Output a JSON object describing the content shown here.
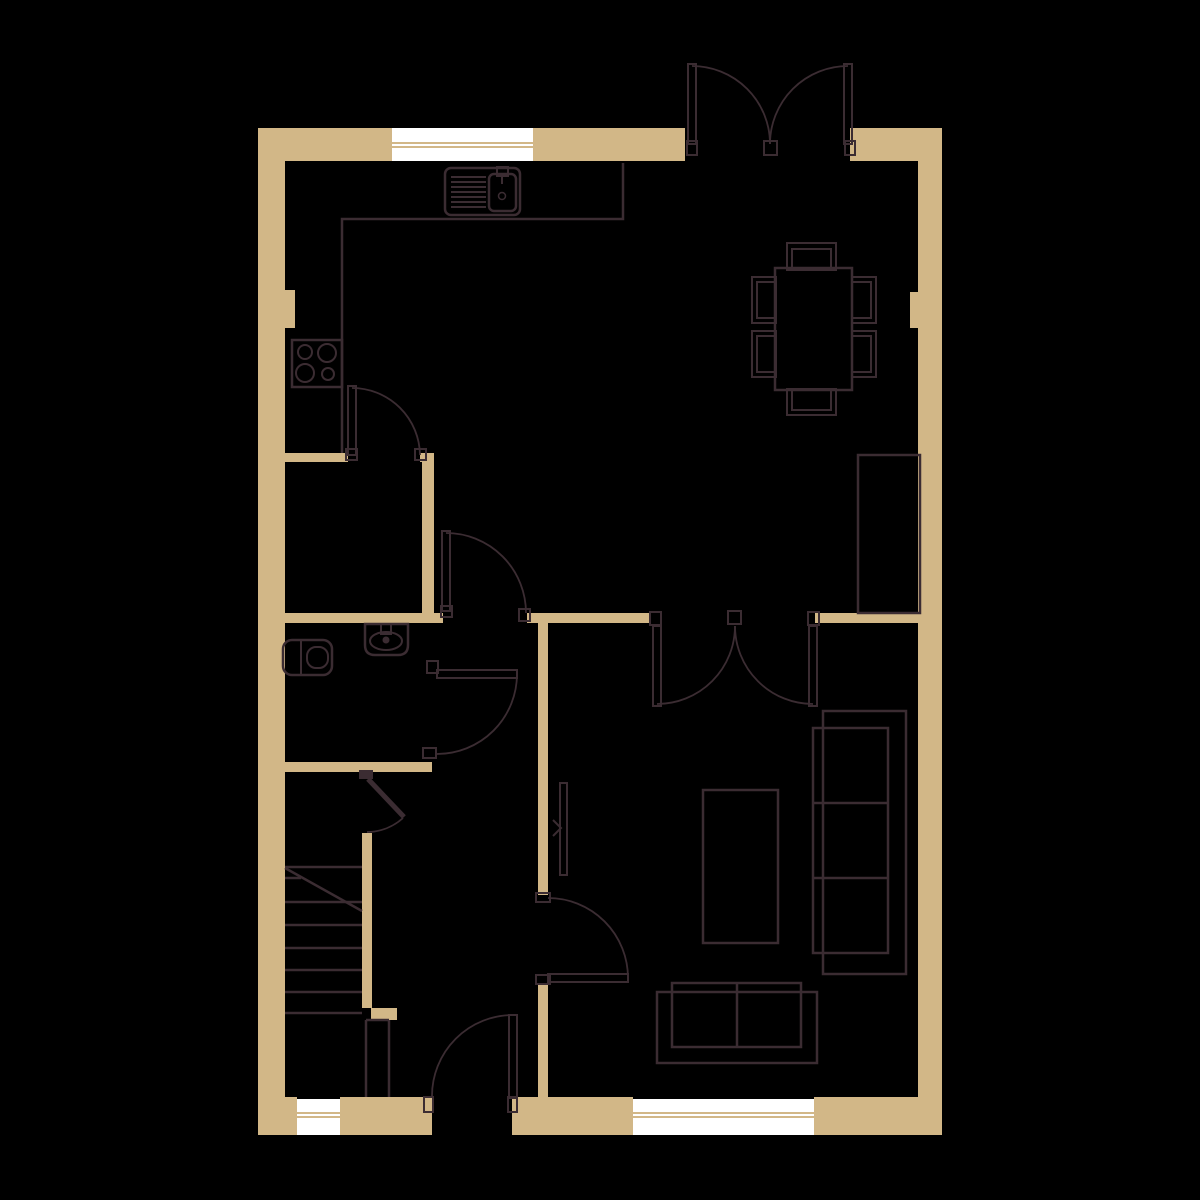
{
  "title": "ground-floor-plan",
  "canvas": {
    "width": 1200,
    "height": 1200,
    "background": "#000000"
  },
  "colors": {
    "wall": "#d2b787",
    "line": "#3b2c32",
    "window": "#ffffff",
    "background": "#000000",
    "none": "none"
  },
  "shapes": [
    {
      "name": "wall-top-left",
      "type": "rect",
      "x": 258,
      "y": 128,
      "w": 427,
      "h": 33,
      "fill": "wall"
    },
    {
      "name": "wall-top-right",
      "type": "rect",
      "x": 850,
      "y": 128,
      "w": 92,
      "h": 33,
      "fill": "wall"
    },
    {
      "name": "wall-left",
      "type": "rect",
      "x": 258,
      "y": 161,
      "w": 27,
      "h": 936,
      "fill": "wall"
    },
    {
      "name": "wall-right",
      "type": "rect",
      "x": 918,
      "y": 161,
      "w": 24,
      "h": 936,
      "fill": "wall"
    },
    {
      "name": "pillar-left",
      "type": "rect",
      "x": 258,
      "y": 290,
      "w": 37,
      "h": 38,
      "fill": "wall"
    },
    {
      "name": "pillar-right",
      "type": "rect",
      "x": 910,
      "y": 292,
      "w": 32,
      "h": 36,
      "fill": "wall"
    },
    {
      "name": "wall-kitchen",
      "type": "rect",
      "x": 258,
      "y": 453,
      "w": 90,
      "h": 9,
      "fill": "wall"
    },
    {
      "name": "wall-kitchen-stub",
      "type": "rect",
      "x": 420,
      "y": 453,
      "w": 14,
      "h": 9,
      "fill": "wall"
    },
    {
      "name": "wall-kitchen-vert",
      "type": "rect",
      "x": 422,
      "y": 462,
      "w": 12,
      "h": 153,
      "fill": "wall"
    },
    {
      "name": "wall-mid-1",
      "type": "rect",
      "x": 258,
      "y": 613,
      "w": 185,
      "h": 10,
      "fill": "wall"
    },
    {
      "name": "wall-mid-2",
      "type": "rect",
      "x": 527,
      "y": 613,
      "w": 123,
      "h": 10,
      "fill": "wall"
    },
    {
      "name": "wall-mid-3",
      "type": "rect",
      "x": 815,
      "y": 613,
      "w": 105,
      "h": 10,
      "fill": "wall"
    },
    {
      "name": "wall-hall-upper",
      "type": "rect",
      "x": 538,
      "y": 623,
      "w": 10,
      "h": 272,
      "fill": "wall"
    },
    {
      "name": "wall-hall-lower",
      "type": "rect",
      "x": 538,
      "y": 983,
      "w": 10,
      "h": 114,
      "fill": "wall"
    },
    {
      "name": "wall-wc-bottom",
      "type": "rect",
      "x": 258,
      "y": 762,
      "w": 174,
      "h": 10,
      "fill": "wall"
    },
    {
      "name": "wall-stairs",
      "type": "rect",
      "x": 362,
      "y": 833,
      "w": 10,
      "h": 175,
      "fill": "wall"
    },
    {
      "name": "wall-newel",
      "type": "rect",
      "x": 371,
      "y": 1008,
      "w": 26,
      "h": 12,
      "fill": "wall"
    },
    {
      "name": "wall-bottom-1",
      "type": "rect",
      "x": 258,
      "y": 1097,
      "w": 39,
      "h": 38,
      "fill": "wall"
    },
    {
      "name": "wall-bottom-2",
      "type": "rect",
      "x": 340,
      "y": 1097,
      "w": 92,
      "h": 38,
      "fill": "wall"
    },
    {
      "name": "wall-bottom-3",
      "type": "rect",
      "x": 512,
      "y": 1097,
      "w": 121,
      "h": 38,
      "fill": "wall"
    },
    {
      "name": "wall-bottom-4",
      "type": "rect",
      "x": 814,
      "y": 1097,
      "w": 128,
      "h": 38,
      "fill": "wall"
    },
    {
      "name": "window-top",
      "type": "rect",
      "x": 392,
      "y": 128,
      "w": 141,
      "h": 33,
      "fill": "window"
    },
    {
      "name": "window-top-bar-1",
      "type": "rect",
      "x": 392,
      "y": 142,
      "w": 141,
      "h": 2,
      "fill": "wall"
    },
    {
      "name": "window-top-bar-2",
      "type": "rect",
      "x": 392,
      "y": 146,
      "w": 141,
      "h": 2,
      "fill": "wall"
    },
    {
      "name": "window-bottom-left",
      "type": "rect",
      "x": 297,
      "y": 1099,
      "w": 43,
      "h": 36,
      "fill": "window"
    },
    {
      "name": "window-bl-bar-1",
      "type": "rect",
      "x": 297,
      "y": 1112,
      "w": 43,
      "h": 2,
      "fill": "wall"
    },
    {
      "name": "window-bl-bar-2",
      "type": "rect",
      "x": 297,
      "y": 1116,
      "w": 43,
      "h": 2,
      "fill": "wall"
    },
    {
      "name": "window-bottom-right",
      "type": "rect",
      "x": 633,
      "y": 1099,
      "w": 181,
      "h": 36,
      "fill": "window"
    },
    {
      "name": "window-br-bar-1",
      "type": "rect",
      "x": 633,
      "y": 1112,
      "w": 181,
      "h": 2,
      "fill": "wall"
    },
    {
      "name": "window-br-bar-2",
      "type": "rect",
      "x": 633,
      "y": 1116,
      "w": 181,
      "h": 2,
      "fill": "wall"
    },
    {
      "name": "kitchen-counter-edge",
      "type": "path",
      "d": "M623 163 V219 H342 V453",
      "stroke": "line",
      "sw": 2.5
    },
    {
      "name": "sink-outline",
      "type": "rect",
      "x": 445,
      "y": 168,
      "w": 75,
      "h": 47,
      "rx": 6,
      "stroke": "line",
      "sw": 2.5
    },
    {
      "name": "sink-drainer-lines",
      "type": "path",
      "d": "M451 177 H486 M451 182 H486 M451 187 H486 M451 192 H486 M451 197 H486 M451 202 H486 M451 207 H486",
      "stroke": "line",
      "sw": 2
    },
    {
      "name": "sink-basin",
      "type": "rect",
      "x": 489,
      "y": 174,
      "w": 27,
      "h": 37,
      "rx": 5,
      "stroke": "line",
      "sw": 2.5
    },
    {
      "name": "sink-tap",
      "type": "rect",
      "x": 497,
      "y": 167,
      "w": 11,
      "h": 9,
      "stroke": "line",
      "sw": 2
    },
    {
      "name": "sink-tap-spout",
      "type": "line",
      "x1": 502,
      "y1": 176,
      "x2": 502,
      "y2": 184,
      "stroke": "line",
      "sw": 2
    },
    {
      "name": "sink-drain",
      "type": "circle",
      "cx": 502,
      "cy": 196,
      "r": 3.5,
      "stroke": "line",
      "sw": 1.5
    },
    {
      "name": "hob-outline",
      "type": "rect",
      "x": 292,
      "y": 340,
      "w": 50,
      "h": 47,
      "stroke": "line",
      "sw": 2.5
    },
    {
      "name": "hob-burner-1",
      "type": "circle",
      "cx": 305,
      "cy": 352,
      "r": 7,
      "stroke": "line",
      "sw": 2
    },
    {
      "name": "hob-burner-2",
      "type": "circle",
      "cx": 327,
      "cy": 353,
      "r": 9,
      "stroke": "line",
      "sw": 2
    },
    {
      "name": "hob-burner-3",
      "type": "circle",
      "cx": 305,
      "cy": 373,
      "r": 9,
      "stroke": "line",
      "sw": 2
    },
    {
      "name": "hob-burner-4",
      "type": "circle",
      "cx": 328,
      "cy": 374,
      "r": 6,
      "stroke": "line",
      "sw": 2
    },
    {
      "name": "dining-table",
      "type": "rect",
      "x": 775,
      "y": 268,
      "w": 77,
      "h": 122,
      "stroke": "line",
      "sw": 2.5
    },
    {
      "name": "chair-top-outer",
      "type": "rect",
      "x": 787,
      "y": 243,
      "w": 49,
      "h": 27,
      "stroke": "line",
      "sw": 2
    },
    {
      "name": "chair-top-inner",
      "type": "rect",
      "x": 792,
      "y": 249,
      "w": 39,
      "h": 21,
      "stroke": "line",
      "sw": 2
    },
    {
      "name": "chair-bottom-outer",
      "type": "rect",
      "x": 787,
      "y": 389,
      "w": 49,
      "h": 26,
      "stroke": "line",
      "sw": 2
    },
    {
      "name": "chair-bottom-inner",
      "type": "rect",
      "x": 792,
      "y": 389,
      "w": 39,
      "h": 21,
      "stroke": "line",
      "sw": 2
    },
    {
      "name": "chair-left-top-outer",
      "type": "rect",
      "x": 752,
      "y": 277,
      "w": 24,
      "h": 46,
      "stroke": "line",
      "sw": 2
    },
    {
      "name": "chair-left-top-inner",
      "type": "rect",
      "x": 757,
      "y": 282,
      "w": 19,
      "h": 36,
      "stroke": "line",
      "sw": 2
    },
    {
      "name": "chair-left-bot-outer",
      "type": "rect",
      "x": 752,
      "y": 331,
      "w": 24,
      "h": 46,
      "stroke": "line",
      "sw": 2
    },
    {
      "name": "chair-left-bot-inner",
      "type": "rect",
      "x": 757,
      "y": 336,
      "w": 19,
      "h": 36,
      "stroke": "line",
      "sw": 2
    },
    {
      "name": "chair-right-top-outer",
      "type": "rect",
      "x": 852,
      "y": 277,
      "w": 24,
      "h": 46,
      "stroke": "line",
      "sw": 2
    },
    {
      "name": "chair-right-top-inner",
      "type": "rect",
      "x": 852,
      "y": 282,
      "w": 19,
      "h": 36,
      "stroke": "line",
      "sw": 2
    },
    {
      "name": "chair-right-bot-outer",
      "type": "rect",
      "x": 852,
      "y": 331,
      "w": 24,
      "h": 46,
      "stroke": "line",
      "sw": 2
    },
    {
      "name": "chair-right-bot-inner",
      "type": "rect",
      "x": 852,
      "y": 336,
      "w": 19,
      "h": 36,
      "stroke": "line",
      "sw": 2
    },
    {
      "name": "tv-unit",
      "type": "rect",
      "x": 858,
      "y": 455,
      "w": 62,
      "h": 158,
      "stroke": "line",
      "sw": 2.5
    },
    {
      "name": "sofa-3seat-back",
      "type": "rect",
      "x": 823,
      "y": 711,
      "w": 83,
      "h": 263,
      "stroke": "line",
      "sw": 2.5
    },
    {
      "name": "sofa-3seat-cushions",
      "type": "rect",
      "x": 813,
      "y": 728,
      "w": 75,
      "h": 225,
      "stroke": "line",
      "sw": 2.5
    },
    {
      "name": "sofa-3seat-dividers",
      "type": "path",
      "d": "M813 803 H888 M813 878 H888",
      "stroke": "line",
      "sw": 2.5
    },
    {
      "name": "coffee-table",
      "type": "rect",
      "x": 703,
      "y": 790,
      "w": 75,
      "h": 153,
      "stroke": "line",
      "sw": 2.5
    },
    {
      "name": "sofa-2seat-back",
      "type": "rect",
      "x": 657,
      "y": 992,
      "w": 160,
      "h": 71,
      "stroke": "line",
      "sw": 2.5
    },
    {
      "name": "sofa-2seat-cushions",
      "type": "rect",
      "x": 672,
      "y": 983,
      "w": 129,
      "h": 64,
      "stroke": "line",
      "sw": 2.5
    },
    {
      "name": "sofa-2seat-divider",
      "type": "path",
      "d": "M737 983 V1047",
      "stroke": "line",
      "sw": 2.5
    },
    {
      "name": "toilet-outline",
      "type": "rect",
      "x": 283,
      "y": 640,
      "w": 49,
      "h": 35,
      "rx": 9,
      "stroke": "line",
      "sw": 2.5
    },
    {
      "name": "toilet-cistern-line",
      "type": "line",
      "x1": 301,
      "y1": 640,
      "x2": 301,
      "y2": 675,
      "stroke": "line",
      "sw": 2
    },
    {
      "name": "toilet-bowl",
      "type": "rect",
      "x": 307,
      "y": 647,
      "w": 21,
      "h": 21,
      "rx": 9,
      "stroke": "line",
      "sw": 2
    },
    {
      "name": "basin-outline",
      "type": "path",
      "d": "M365 624 H408 V645 Q408 655 398 655 H375 Q365 655 365 645 Z",
      "stroke": "line",
      "sw": 2.5
    },
    {
      "name": "basin-bowl",
      "type": "ellipse",
      "cx": 386,
      "cy": 641,
      "ex": 16,
      "ey": 9,
      "stroke": "line",
      "sw": 2
    },
    {
      "name": "basin-tap",
      "type": "rect",
      "x": 381,
      "y": 624,
      "w": 10,
      "h": 10,
      "stroke": "line",
      "sw": 2
    },
    {
      "name": "basin-tap-knob",
      "type": "circle",
      "cx": 386,
      "cy": 640,
      "r": 3.5,
      "fill": "line"
    },
    {
      "name": "radiator",
      "type": "rect",
      "x": 560,
      "y": 783,
      "w": 7,
      "h": 92,
      "stroke": "line",
      "sw": 2
    },
    {
      "name": "radiator-valve-mark",
      "type": "path",
      "d": "M553 820 L561 828 L553 836",
      "stroke": "line",
      "sw": 2
    },
    {
      "name": "stair-treads",
      "type": "path",
      "d": "M285 867 H362 M285 878 H301 M285 902 H362 M285 925 H362 M285 948 H362 M285 970 H362 M285 992 H362 M285 1013 H362",
      "stroke": "line",
      "sw": 2.5
    },
    {
      "name": "stair-break-diagonal",
      "type": "line",
      "x1": 285,
      "y1": 868,
      "x2": 362,
      "y2": 911,
      "stroke": "line",
      "sw": 2.5
    },
    {
      "name": "stair-railing",
      "type": "path",
      "d": "M366 1020 V1097 M389 1020 V1097 M366 1020 H389",
      "stroke": "line",
      "sw": 2.5
    },
    {
      "name": "french-door-left-leaf",
      "type": "rect",
      "x": 688,
      "y": 64,
      "w": 8,
      "h": 80,
      "stroke": "line",
      "sw": 2
    },
    {
      "name": "french-door-right-leaf",
      "type": "rect",
      "x": 844,
      "y": 64,
      "w": 8,
      "h": 80,
      "stroke": "line",
      "sw": 2
    },
    {
      "name": "french-door-left-arc",
      "type": "path",
      "d": "M692 66 A78 78 0 0 1 770 144",
      "stroke": "line",
      "sw": 1.8
    },
    {
      "name": "french-door-right-arc",
      "type": "path",
      "d": "M848 66 A78 78 0 0 0 770 144",
      "stroke": "line",
      "sw": 1.8
    },
    {
      "name": "french-door-jamb-left",
      "type": "rect",
      "x": 687,
      "y": 141,
      "w": 10,
      "h": 14,
      "stroke": "line",
      "sw": 2
    },
    {
      "name": "french-door-jamb-right",
      "type": "rect",
      "x": 845,
      "y": 141,
      "w": 10,
      "h": 14,
      "stroke": "line",
      "sw": 2
    },
    {
      "name": "french-door-jamb-mid",
      "type": "rect",
      "x": 764,
      "y": 141,
      "w": 13,
      "h": 14,
      "stroke": "line",
      "sw": 2
    },
    {
      "name": "double-door-left-leaf",
      "type": "rect",
      "x": 653,
      "y": 626,
      "w": 8,
      "h": 80,
      "stroke": "line",
      "sw": 2
    },
    {
      "name": "double-door-right-leaf",
      "type": "rect",
      "x": 809,
      "y": 626,
      "w": 8,
      "h": 80,
      "stroke": "line",
      "sw": 2
    },
    {
      "name": "double-door-left-arc",
      "type": "path",
      "d": "M657 704 A78 78 0 0 0 735 626",
      "stroke": "line",
      "sw": 1.8
    },
    {
      "name": "double-door-right-arc",
      "type": "path",
      "d": "M813 704 A78 78 0 0 1 735 626",
      "stroke": "line",
      "sw": 1.8
    },
    {
      "name": "double-door-jamb-left",
      "type": "rect",
      "x": 650,
      "y": 612,
      "w": 11,
      "h": 13,
      "stroke": "line",
      "sw": 2
    },
    {
      "name": "double-door-jamb-right",
      "type": "rect",
      "x": 808,
      "y": 612,
      "w": 11,
      "h": 13,
      "stroke": "line",
      "sw": 2
    },
    {
      "name": "double-door-jamb-mid",
      "type": "rect",
      "x": 728,
      "y": 611,
      "w": 13,
      "h": 13,
      "stroke": "line",
      "sw": 2
    },
    {
      "name": "kitchen-door-leaf",
      "type": "rect",
      "x": 348,
      "y": 386,
      "w": 8,
      "h": 69,
      "stroke": "line",
      "sw": 2
    },
    {
      "name": "kitchen-door-arc",
      "type": "path",
      "d": "M352 388 A68 68 0 0 1 420 455",
      "stroke": "line",
      "sw": 1.8
    },
    {
      "name": "kitchen-door-jamb-1",
      "type": "rect",
      "x": 346,
      "y": 449,
      "w": 11,
      "h": 11,
      "stroke": "line",
      "sw": 2
    },
    {
      "name": "kitchen-door-jamb-2",
      "type": "rect",
      "x": 415,
      "y": 449,
      "w": 11,
      "h": 11,
      "stroke": "line",
      "sw": 2
    },
    {
      "name": "hall-door-leaf",
      "type": "rect",
      "x": 442,
      "y": 531,
      "w": 8,
      "h": 80,
      "stroke": "line",
      "sw": 2
    },
    {
      "name": "hall-door-arc",
      "type": "path",
      "d": "M446 533 A80 80 0 0 1 526 613",
      "stroke": "line",
      "sw": 1.8
    },
    {
      "name": "hall-door-jamb-1",
      "type": "rect",
      "x": 441,
      "y": 606,
      "w": 11,
      "h": 11,
      "stroke": "line",
      "sw": 2
    },
    {
      "name": "hall-door-jamb-2",
      "type": "rect",
      "x": 519,
      "y": 609,
      "w": 11,
      "h": 12,
      "stroke": "line",
      "sw": 2
    },
    {
      "name": "wc-door-leaf",
      "type": "rect",
      "x": 437,
      "y": 670,
      "w": 80,
      "h": 8,
      "stroke": "line",
      "sw": 2
    },
    {
      "name": "wc-door-arc",
      "type": "path",
      "d": "M517 674 A80 80 0 0 1 437 754",
      "stroke": "line",
      "sw": 1.8
    },
    {
      "name": "wc-door-jamb-1",
      "type": "rect",
      "x": 427,
      "y": 661,
      "w": 11,
      "h": 12,
      "stroke": "line",
      "sw": 2
    },
    {
      "name": "wc-door-jamb-2",
      "type": "rect",
      "x": 423,
      "y": 748,
      "w": 13,
      "h": 10,
      "stroke": "line",
      "sw": 2
    },
    {
      "name": "understairs-door-leaf",
      "type": "line",
      "x1": 368,
      "y1": 779,
      "x2": 404,
      "y2": 817,
      "stroke": "line",
      "sw": 5
    },
    {
      "name": "understairs-door-arc",
      "type": "path",
      "d": "M403 818 A54 54 0 0 1 367 832",
      "stroke": "line",
      "sw": 1.8
    },
    {
      "name": "understairs-door-jamb",
      "type": "rect",
      "x": 359,
      "y": 770,
      "w": 14,
      "h": 9,
      "fill": "line"
    },
    {
      "name": "living-door-leaf",
      "type": "rect",
      "x": 548,
      "y": 974,
      "w": 80,
      "h": 8,
      "stroke": "line",
      "sw": 2
    },
    {
      "name": "living-door-arc",
      "type": "path",
      "d": "M628 978 A80 80 0 0 0 548 898",
      "stroke": "line",
      "sw": 1.8
    },
    {
      "name": "living-door-jamb-1",
      "type": "rect",
      "x": 536,
      "y": 893,
      "w": 14,
      "h": 9,
      "stroke": "line",
      "sw": 2
    },
    {
      "name": "living-door-jamb-2",
      "type": "rect",
      "x": 536,
      "y": 975,
      "w": 14,
      "h": 9,
      "stroke": "line",
      "sw": 2
    },
    {
      "name": "front-door-leaf",
      "type": "rect",
      "x": 509,
      "y": 1015,
      "w": 8,
      "h": 83,
      "stroke": "line",
      "sw": 2
    },
    {
      "name": "front-door-arc",
      "type": "path",
      "d": "M513 1015 A81 81 0 0 0 432 1096",
      "stroke": "line",
      "sw": 1.8
    },
    {
      "name": "front-door-jamb-1",
      "type": "rect",
      "x": 424,
      "y": 1097,
      "w": 9,
      "h": 15,
      "stroke": "line",
      "sw": 2
    },
    {
      "name": "front-door-jamb-2",
      "type": "rect",
      "x": 508,
      "y": 1097,
      "w": 9,
      "h": 15,
      "stroke": "line",
      "sw": 2
    }
  ]
}
